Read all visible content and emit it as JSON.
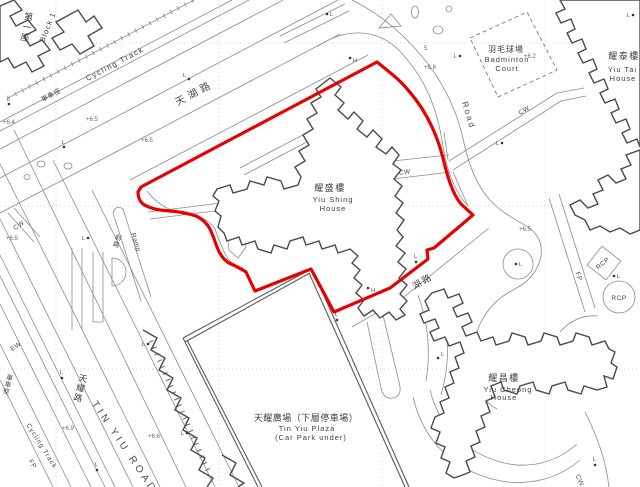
{
  "colors": {
    "boundary": "#e60000",
    "line": "#8c8c8c",
    "building": "#4a4a4a",
    "plaza": "#5a5a5a"
  },
  "labels": {
    "block1_zh": "第一座",
    "block1_en": "Block 1",
    "cycling_track": "Cycling Track",
    "cycling_track_zh": "單車徑",
    "tin_wu_road_zh": "天湖路",
    "wu_road_zh": "湖路",
    "road_en": "Road",
    "badminton_zh": "羽毛球場",
    "badminton_en1": "Badminton",
    "badminton_en2": "Court",
    "yiu_tai_zh": "耀泰樓",
    "yiu_tai_en1": "Yiu Tai",
    "yiu_tai_en2": "House",
    "yiu_shing_zh": "耀盛樓",
    "yiu_shing_en1": "Yiu Shing",
    "yiu_shing_en2": "House",
    "yiu_cheong_zh": "耀昌樓",
    "yiu_cheong_en1": "Yiu Cheong",
    "yiu_cheong_en2": "House",
    "plaza_zh": "天耀廣場（下層停車場）",
    "plaza_en1": "Tin Yiu Plaza",
    "plaza_en2": "(Car Park under)",
    "tin_yiu_road_en": "TIN YIU ROAD",
    "tin_yiu_road_zh": "天耀路",
    "ramp_en": "Ramp",
    "ramp_zh": "斜路",
    "cw": "CW",
    "ew": "EW",
    "fp": "FP",
    "rcp": "RCP",
    "lamp": "L",
    "hydrant": "H"
  },
  "spot_heights": [
    "+6.4",
    "+6.5",
    "+6.5",
    "+6.5",
    "+6.8",
    "+6.2",
    "+6.5",
    "+6.9",
    "+6.6",
    "5"
  ]
}
